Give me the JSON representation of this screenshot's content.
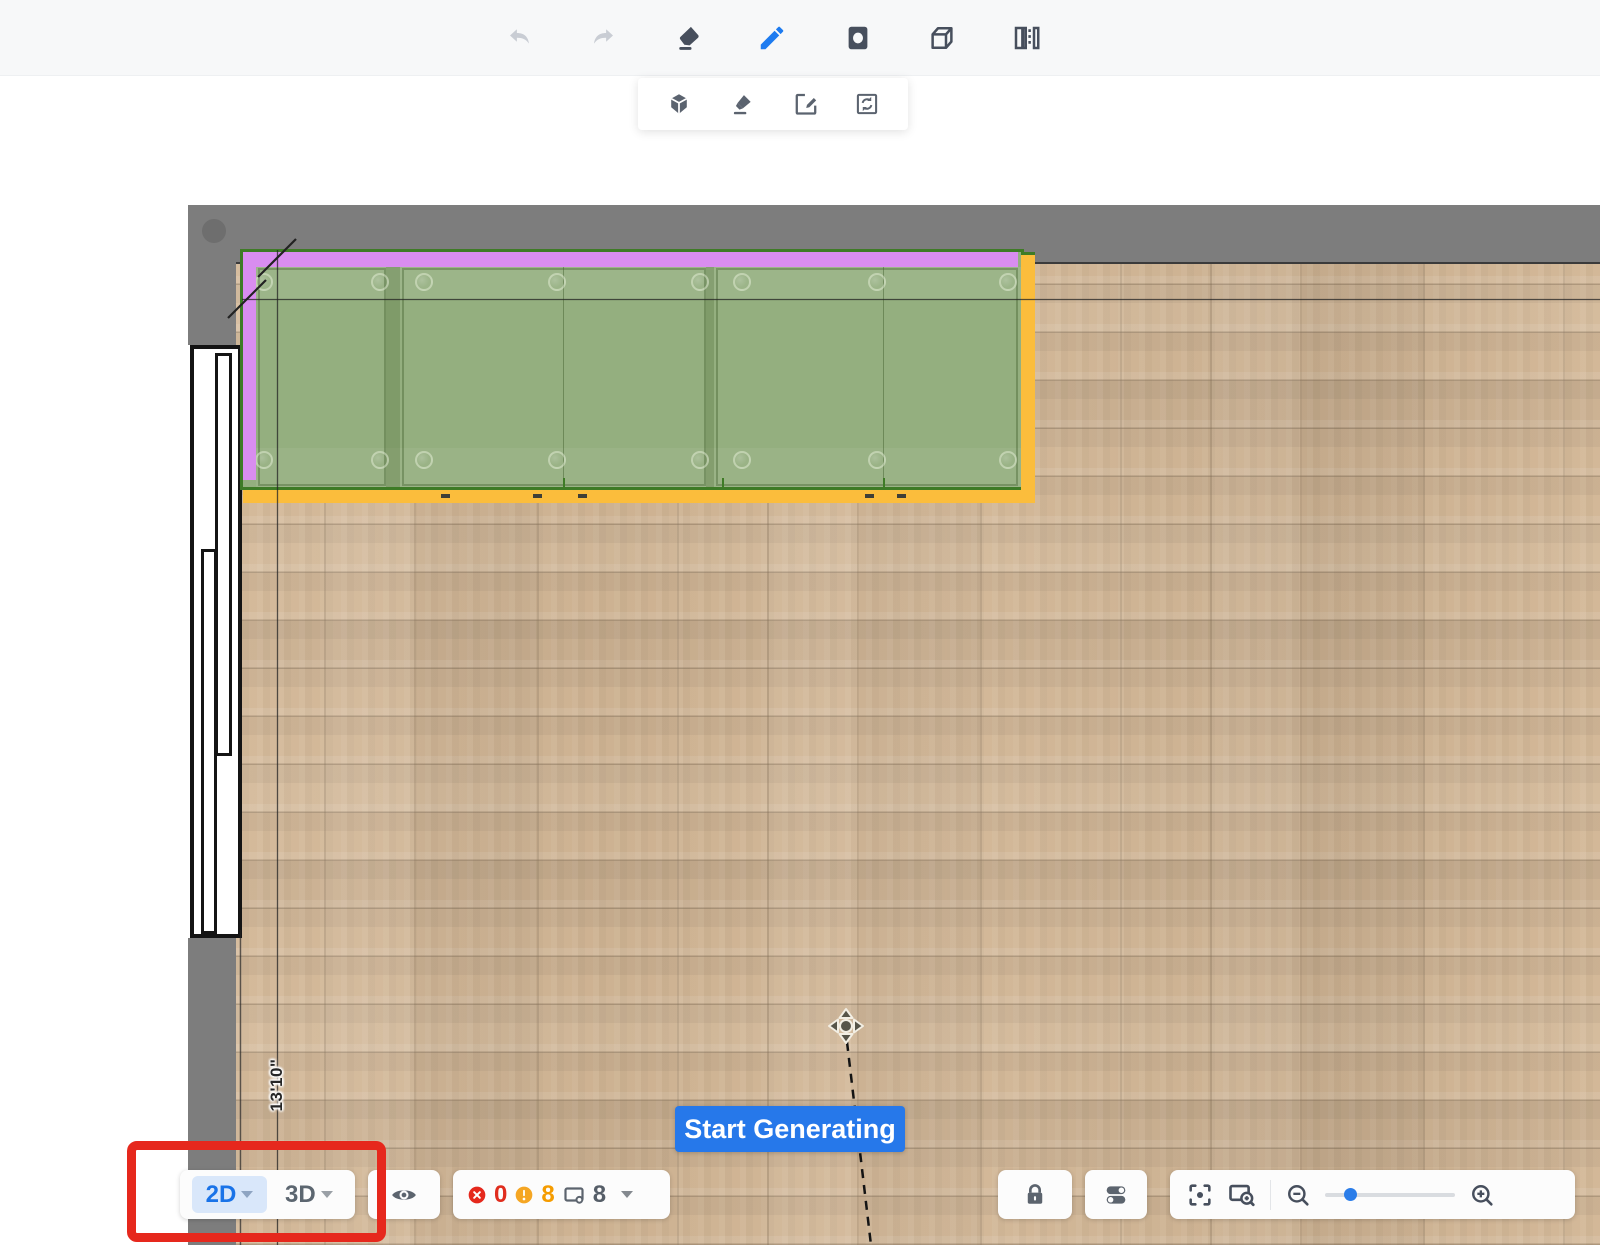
{
  "header": {
    "tools": [
      {
        "name": "undo",
        "state": "disabled"
      },
      {
        "name": "redo",
        "state": "disabled"
      },
      {
        "name": "eraser",
        "state": "default"
      },
      {
        "name": "pencil",
        "state": "active"
      },
      {
        "name": "room-shape",
        "state": "default"
      },
      {
        "name": "model-cube",
        "state": "default"
      },
      {
        "name": "door-window",
        "state": "default"
      }
    ],
    "sub_tools": [
      {
        "name": "orbit-cube"
      },
      {
        "name": "marker"
      },
      {
        "name": "edit-square"
      },
      {
        "name": "sync-square"
      }
    ]
  },
  "canvas": {
    "dimension_label": "13'10\"",
    "generate_button": "Start Generating"
  },
  "bottom_bar": {
    "view_2d": "2D",
    "view_3d": "3D",
    "error_count": "0",
    "warning_count": "8",
    "model_count": "8"
  },
  "colors": {
    "accent_blue": "#1a73e8",
    "button_blue": "#2678ea",
    "error_red": "#e5281c",
    "warning_orange": "#f5a623",
    "selection_purple": "#d98df0",
    "selection_yellow": "#fbbd3c",
    "cabinet_green": "#94af7f",
    "cabinet_outline_green": "#3e7b26",
    "wall_gray": "#7d7d7d",
    "floor_tan": "#d2b695",
    "annotation_red": "#e6281d"
  }
}
